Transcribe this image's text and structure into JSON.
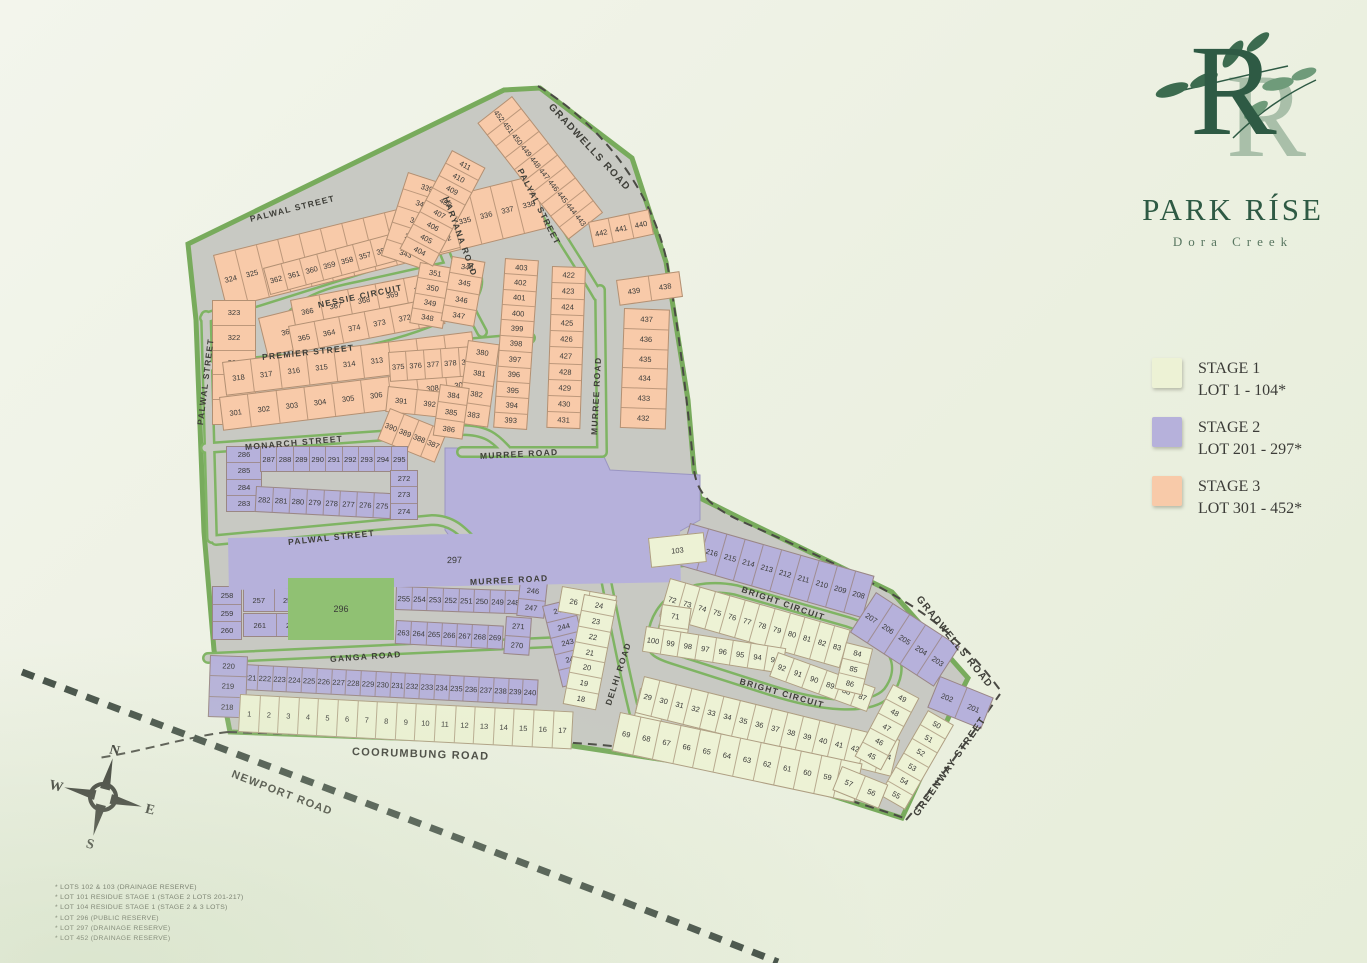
{
  "logo": {
    "monogram": "R",
    "title": "PARK RÍSE",
    "subtitle": "Dora Creek"
  },
  "legend": {
    "items": [
      {
        "stage": "STAGE 1",
        "range": "LOT 1 - 104*",
        "color": "#edf2d5"
      },
      {
        "stage": "STAGE 2",
        "range": "LOT 201 - 297*",
        "color": "#b6b1db"
      },
      {
        "stage": "STAGE 3",
        "range": "LOT 301 - 452*",
        "color": "#f8caa9"
      }
    ]
  },
  "footnotes": [
    "* LOTS 102 & 103 (DRAINAGE RESERVE)",
    "* LOT 101 RESIDUE STAGE 1 (STAGE 2 LOTS 201-217)",
    "* LOT 104 RESIDUE STAGE 1 (STAGE 2 & 3 LOTS)",
    "* LOT 296 (PUBLIC RESERVE)",
    "* LOT 297 (DRAINAGE RESERVE)",
    "* LOT 452 (DRAINAGE RESERVE)"
  ],
  "compass": {
    "n": "N",
    "e": "E",
    "s": "S",
    "w": "W"
  },
  "colors": {
    "stage1": "#edf2d5",
    "stage2": "#b6b1db",
    "stage3": "#f8caa9",
    "reserve_green": "#90c173",
    "road": "#c8c9c3",
    "verge": "#7fb463",
    "boundary": "#4a4a44",
    "logo_green": "#2e5a44"
  },
  "map": {
    "road_labels": [
      {
        "t": "GRADWELLS ROAD",
        "x": 550,
        "y": 100,
        "r": 47,
        "s": 10
      },
      {
        "t": "GRADWELLS ROAD",
        "x": 918,
        "y": 592,
        "r": 51,
        "s": 10
      },
      {
        "t": "PALWAL STREET",
        "x": 250,
        "y": 214,
        "r": -14
      },
      {
        "t": "PALWAL STREET",
        "x": 200,
        "y": 420,
        "r": -83
      },
      {
        "t": "PALWAL STREET",
        "x": 288,
        "y": 537,
        "r": -6
      },
      {
        "t": "HARYANA ROAD",
        "x": 446,
        "y": 192,
        "r": 70
      },
      {
        "t": "PALYAL STREET",
        "x": 520,
        "y": 164,
        "r": 63
      },
      {
        "t": "NESSIE CIRCUIT",
        "x": 318,
        "y": 300,
        "r": -12
      },
      {
        "t": "PREMIER STREET",
        "x": 262,
        "y": 352,
        "r": -6
      },
      {
        "t": "MONARCH STREET",
        "x": 245,
        "y": 442,
        "r": -5
      },
      {
        "t": "MURREE ROAD",
        "x": 480,
        "y": 451,
        "r": -3
      },
      {
        "t": "MURREE ROAD",
        "x": 594,
        "y": 430,
        "r": -87
      },
      {
        "t": "MURREE ROAD",
        "x": 470,
        "y": 577,
        "r": -3
      },
      {
        "t": "GANGA ROAD",
        "x": 330,
        "y": 654,
        "r": -4
      },
      {
        "t": "DELHI ROAD",
        "x": 608,
        "y": 700,
        "r": -72
      },
      {
        "t": "BRIGHT CIRCUIT",
        "x": 742,
        "y": 584,
        "r": 19
      },
      {
        "t": "BRIGHT CIRCUIT",
        "x": 740,
        "y": 676,
        "r": 16
      },
      {
        "t": "GREENWAY STREET",
        "x": 916,
        "y": 810,
        "r": -55,
        "s": 10
      },
      {
        "t": "COORUMBUNG ROAD",
        "x": 352,
        "y": 746,
        "r": 2,
        "s": 11
      },
      {
        "t": "NEWPORT ROAD",
        "x": 232,
        "y": 768,
        "r": 21,
        "s": 11
      }
    ],
    "blocks": [
      {
        "s": 3,
        "x": 213,
        "y": 255,
        "w": 330,
        "h": 55,
        "r": -14,
        "d": "r",
        "l": [
          324,
          325,
          326,
          327,
          328,
          329,
          330,
          331,
          332,
          333,
          334,
          335,
          336,
          337,
          338
        ]
      },
      {
        "s": 3,
        "x": 212,
        "y": 300,
        "w": 44,
        "h": 125,
        "r": 0,
        "d": "c",
        "l": [
          323,
          322,
          321,
          320,
          319
        ]
      },
      {
        "s": 3,
        "x": 258,
        "y": 318,
        "w": 100,
        "h": 40,
        "r": -14,
        "d": "r",
        "l": [
          363,
          354
        ]
      },
      {
        "s": 3,
        "x": 263,
        "y": 268,
        "w": 148,
        "h": 28,
        "r": -15,
        "d": "r",
        "l": [
          362,
          361,
          360,
          359,
          358,
          357,
          356,
          355
        ]
      },
      {
        "s": 3,
        "x": 404,
        "y": 236,
        "w": 52,
        "h": 26,
        "r": -15,
        "d": "r",
        "l": [
          353,
          352
        ]
      },
      {
        "s": 3,
        "x": 290,
        "y": 300,
        "w": 145,
        "h": 28,
        "r": -11,
        "d": "r",
        "l": [
          366,
          367,
          368,
          369,
          370
        ]
      },
      {
        "s": 3,
        "x": 288,
        "y": 326,
        "w": 155,
        "h": 28,
        "r": -11,
        "d": "r",
        "l": [
          365,
          364,
          374,
          373,
          372,
          371
        ]
      },
      {
        "s": 3,
        "x": 222,
        "y": 362,
        "w": 252,
        "h": 34,
        "r": -7,
        "d": "r",
        "l": [
          318,
          317,
          316,
          315,
          314,
          313,
          312,
          311,
          310
        ]
      },
      {
        "s": 3,
        "x": 219,
        "y": 397,
        "w": 256,
        "h": 34,
        "r": -7,
        "d": "r",
        "l": [
          301,
          302,
          303,
          304,
          305,
          306,
          307,
          308,
          309
        ]
      },
      {
        "s": 3,
        "x": 408,
        "y": 172,
        "w": 46,
        "h": 88,
        "r": 18,
        "d": "c",
        "l": [
          339,
          340,
          341,
          342,
          343
        ]
      },
      {
        "s": 3,
        "x": 420,
        "y": 262,
        "w": 34,
        "h": 62,
        "r": 10,
        "d": "c",
        "l": [
          351,
          350,
          349,
          348
        ]
      },
      {
        "s": 3,
        "x": 452,
        "y": 256,
        "w": 34,
        "h": 66,
        "r": 10,
        "d": "c",
        "l": [
          344,
          345,
          346,
          347
        ]
      },
      {
        "s": 3,
        "x": 388,
        "y": 352,
        "w": 88,
        "h": 30,
        "r": -4,
        "d": "r",
        "l": [
          375,
          376,
          377,
          378,
          379
        ]
      },
      {
        "s": 3,
        "x": 388,
        "y": 386,
        "w": 58,
        "h": 26,
        "r": 6,
        "d": "r",
        "l": [
          391,
          392
        ]
      },
      {
        "s": 3,
        "x": 390,
        "y": 408,
        "w": 62,
        "h": 34,
        "r": 22,
        "d": "r",
        "l": [
          390,
          389,
          388,
          387
        ]
      },
      {
        "s": 3,
        "x": 468,
        "y": 340,
        "w": 32,
        "h": 84,
        "r": 8,
        "d": "c",
        "l": [
          380,
          381,
          382,
          383
        ]
      },
      {
        "s": 3,
        "x": 440,
        "y": 384,
        "w": 30,
        "h": 52,
        "r": 8,
        "d": "c",
        "l": [
          384,
          385,
          386
        ]
      },
      {
        "s": 3,
        "x": 512,
        "y": 96,
        "w": 148,
        "h": 44,
        "r": 52,
        "d": "r",
        "l": [
          452,
          451,
          450,
          449,
          448,
          447,
          446,
          445,
          444,
          443
        ]
      },
      {
        "s": 3,
        "x": 588,
        "y": 222,
        "w": 62,
        "h": 26,
        "r": -12,
        "d": "r",
        "l": [
          442,
          441,
          440
        ]
      },
      {
        "s": 3,
        "x": 452,
        "y": 150,
        "w": 38,
        "h": 112,
        "r": 28,
        "d": "c",
        "l": [
          411,
          410,
          409,
          408,
          407,
          406,
          405,
          404
        ]
      },
      {
        "s": 3,
        "x": 505,
        "y": 258,
        "w": 34,
        "h": 170,
        "r": 4,
        "d": "c",
        "l": [
          403,
          402,
          401,
          400,
          399,
          398,
          397,
          396,
          395,
          394,
          393
        ]
      },
      {
        "s": 3,
        "x": 552,
        "y": 266,
        "w": 34,
        "h": 162,
        "r": 2,
        "d": "c",
        "l": [
          422,
          423,
          424,
          425,
          426,
          427,
          428,
          429,
          430,
          431
        ]
      },
      {
        "s": 3,
        "x": 616,
        "y": 280,
        "w": 64,
        "h": 26,
        "r": -8,
        "d": "r",
        "l": [
          439,
          438
        ]
      },
      {
        "s": 3,
        "x": 624,
        "y": 308,
        "w": 46,
        "h": 120,
        "r": 2,
        "d": "c",
        "l": [
          437,
          436,
          435,
          434,
          433,
          432
        ]
      },
      {
        "s": 2,
        "x": 226,
        "y": 446,
        "w": 36,
        "h": 66,
        "r": 0,
        "d": "c",
        "l": [
          286,
          285,
          284,
          283
        ]
      },
      {
        "s": 2,
        "x": 260,
        "y": 446,
        "w": 148,
        "h": 26,
        "r": 0,
        "d": "r",
        "l": [
          287,
          288,
          289,
          290,
          291,
          292,
          293,
          294,
          295
        ]
      },
      {
        "s": 2,
        "x": 256,
        "y": 486,
        "w": 136,
        "h": 26,
        "r": 3,
        "d": "r",
        "l": [
          282,
          281,
          280,
          279,
          278,
          277,
          276,
          275
        ]
      },
      {
        "s": 2,
        "x": 390,
        "y": 470,
        "w": 28,
        "h": 50,
        "r": 0,
        "d": "c",
        "l": [
          272,
          273,
          274
        ]
      },
      {
        "s": 2,
        "x": 690,
        "y": 523,
        "w": 192,
        "h": 44,
        "r": 16,
        "d": "r",
        "l": [
          217,
          216,
          215,
          214,
          213,
          212,
          211,
          210,
          209,
          208
        ]
      },
      {
        "s": 2,
        "x": 876,
        "y": 592,
        "w": 100,
        "h": 48,
        "r": 33,
        "d": "r",
        "l": [
          207,
          206,
          205,
          204,
          203
        ]
      },
      {
        "s": 2,
        "x": 940,
        "y": 676,
        "w": 58,
        "h": 34,
        "r": 22,
        "d": "r",
        "l": [
          202,
          201
        ]
      },
      {
        "s": 2,
        "x": 212,
        "y": 586,
        "w": 30,
        "h": 54,
        "r": 0,
        "d": "c",
        "l": [
          258,
          259,
          260
        ]
      },
      {
        "s": 2,
        "x": 243,
        "y": 588,
        "w": 62,
        "h": 24,
        "r": 0,
        "d": "r",
        "l": [
          257,
          256
        ]
      },
      {
        "s": 2,
        "x": 243,
        "y": 613,
        "w": 66,
        "h": 24,
        "r": 0,
        "d": "r",
        "l": [
          261,
          262
        ]
      },
      {
        "s": 2,
        "x": 396,
        "y": 586,
        "w": 126,
        "h": 24,
        "r": 2,
        "d": "r",
        "l": [
          255,
          254,
          253,
          252,
          251,
          250,
          249,
          248
        ]
      },
      {
        "s": 2,
        "x": 520,
        "y": 580,
        "w": 28,
        "h": 36,
        "r": 6,
        "d": "c",
        "l": [
          246,
          247
        ]
      },
      {
        "s": 2,
        "x": 396,
        "y": 620,
        "w": 108,
        "h": 24,
        "r": 3,
        "d": "r",
        "l": [
          263,
          264,
          265,
          266,
          267,
          268,
          269
        ]
      },
      {
        "s": 2,
        "x": 506,
        "y": 616,
        "w": 26,
        "h": 38,
        "r": 4,
        "d": "c",
        "l": [
          271,
          270
        ]
      },
      {
        "s": 2,
        "x": 542,
        "y": 606,
        "w": 32,
        "h": 84,
        "r": -14,
        "d": "c",
        "l": [
          245,
          244,
          243,
          242,
          241
        ]
      },
      {
        "s": 2,
        "x": 243,
        "y": 664,
        "w": 296,
        "h": 26,
        "r": 3,
        "d": "r",
        "l": [
          221,
          222,
          223,
          224,
          225,
          226,
          227,
          228,
          229,
          230,
          231,
          232,
          233,
          234,
          235,
          236,
          237,
          238,
          239,
          240
        ]
      },
      {
        "s": 2,
        "x": 210,
        "y": 655,
        "w": 38,
        "h": 62,
        "r": 2,
        "d": "c",
        "l": [
          220,
          219,
          218
        ]
      },
      {
        "s": 2,
        "x": 228,
        "y": 538,
        "w": 452,
        "h": 52,
        "r": -1,
        "d": "r",
        "l": [
          297
        ],
        "p": true
      },
      {
        "s": "g",
        "x": 288,
        "y": 578,
        "w": 106,
        "h": 62,
        "r": 0,
        "d": "r",
        "l": [
          296
        ],
        "p": true
      },
      {
        "s": 1,
        "x": 240,
        "y": 694,
        "w": 334,
        "h": 38,
        "r": 3,
        "d": "r",
        "l": [
          1,
          2,
          3,
          4,
          5,
          6,
          7,
          8,
          9,
          10,
          11,
          12,
          13,
          14,
          15,
          16,
          17
        ]
      },
      {
        "s": 1,
        "x": 562,
        "y": 586,
        "w": 56,
        "h": 26,
        "r": 10,
        "d": "r",
        "l": [
          26,
          25
        ]
      },
      {
        "s": 1,
        "x": 584,
        "y": 594,
        "w": 34,
        "h": 112,
        "r": 11,
        "d": "c",
        "l": [
          24,
          23,
          22,
          21,
          20,
          19,
          18
        ]
      },
      {
        "s": 1,
        "x": 648,
        "y": 538,
        "w": 56,
        "h": 30,
        "r": -6,
        "d": "r",
        "l": [
          103
        ]
      },
      {
        "s": 1,
        "x": 670,
        "y": 578,
        "w": 188,
        "h": 40,
        "r": 16,
        "d": "r",
        "l": [
          72,
          73,
          74,
          75,
          76,
          77,
          78,
          79,
          80,
          81,
          82,
          83
        ]
      },
      {
        "s": 1,
        "x": 662,
        "y": 604,
        "w": 30,
        "h": 42,
        "r": 8,
        "d": "c",
        "l": [
          71,
          70
        ]
      },
      {
        "s": 1,
        "x": 646,
        "y": 626,
        "w": 142,
        "h": 26,
        "r": 9,
        "d": "r",
        "l": [
          100,
          99,
          98,
          97,
          96,
          95,
          94,
          93
        ]
      },
      {
        "s": 1,
        "x": 778,
        "y": 652,
        "w": 104,
        "h": 26,
        "r": 20,
        "d": "r",
        "l": [
          92,
          91,
          90,
          89,
          88,
          87
        ]
      },
      {
        "s": 1,
        "x": 846,
        "y": 642,
        "w": 28,
        "h": 48,
        "r": 14,
        "d": "c",
        "l": [
          84,
          85,
          86
        ]
      },
      {
        "s": 1,
        "x": 640,
        "y": 688,
        "w": 28,
        "h": 42,
        "r": 12,
        "d": "c",
        "l": [
          28,
          27
        ]
      },
      {
        "s": 1,
        "x": 644,
        "y": 676,
        "w": 264,
        "h": 38,
        "r": 14,
        "d": "r",
        "l": [
          29,
          30,
          31,
          32,
          33,
          34,
          35,
          36,
          37,
          38,
          39,
          40,
          41,
          42,
          43,
          44
        ]
      },
      {
        "s": 1,
        "x": 620,
        "y": 712,
        "w": 248,
        "h": 40,
        "r": 12,
        "d": "r",
        "l": [
          69,
          68,
          67,
          66,
          65,
          64,
          63,
          62,
          61,
          60,
          59,
          58
        ]
      },
      {
        "s": 1,
        "x": 893,
        "y": 684,
        "w": 30,
        "h": 82,
        "r": 28,
        "d": "c",
        "l": [
          49,
          48,
          47,
          46,
          45
        ]
      },
      {
        "s": 1,
        "x": 928,
        "y": 710,
        "w": 30,
        "h": 98,
        "r": 30,
        "d": "c",
        "l": [
          50,
          51,
          52,
          53,
          54,
          55
        ]
      },
      {
        "s": 1,
        "x": 842,
        "y": 766,
        "w": 50,
        "h": 26,
        "r": 22,
        "d": "r",
        "l": [
          57,
          56
        ]
      }
    ]
  }
}
